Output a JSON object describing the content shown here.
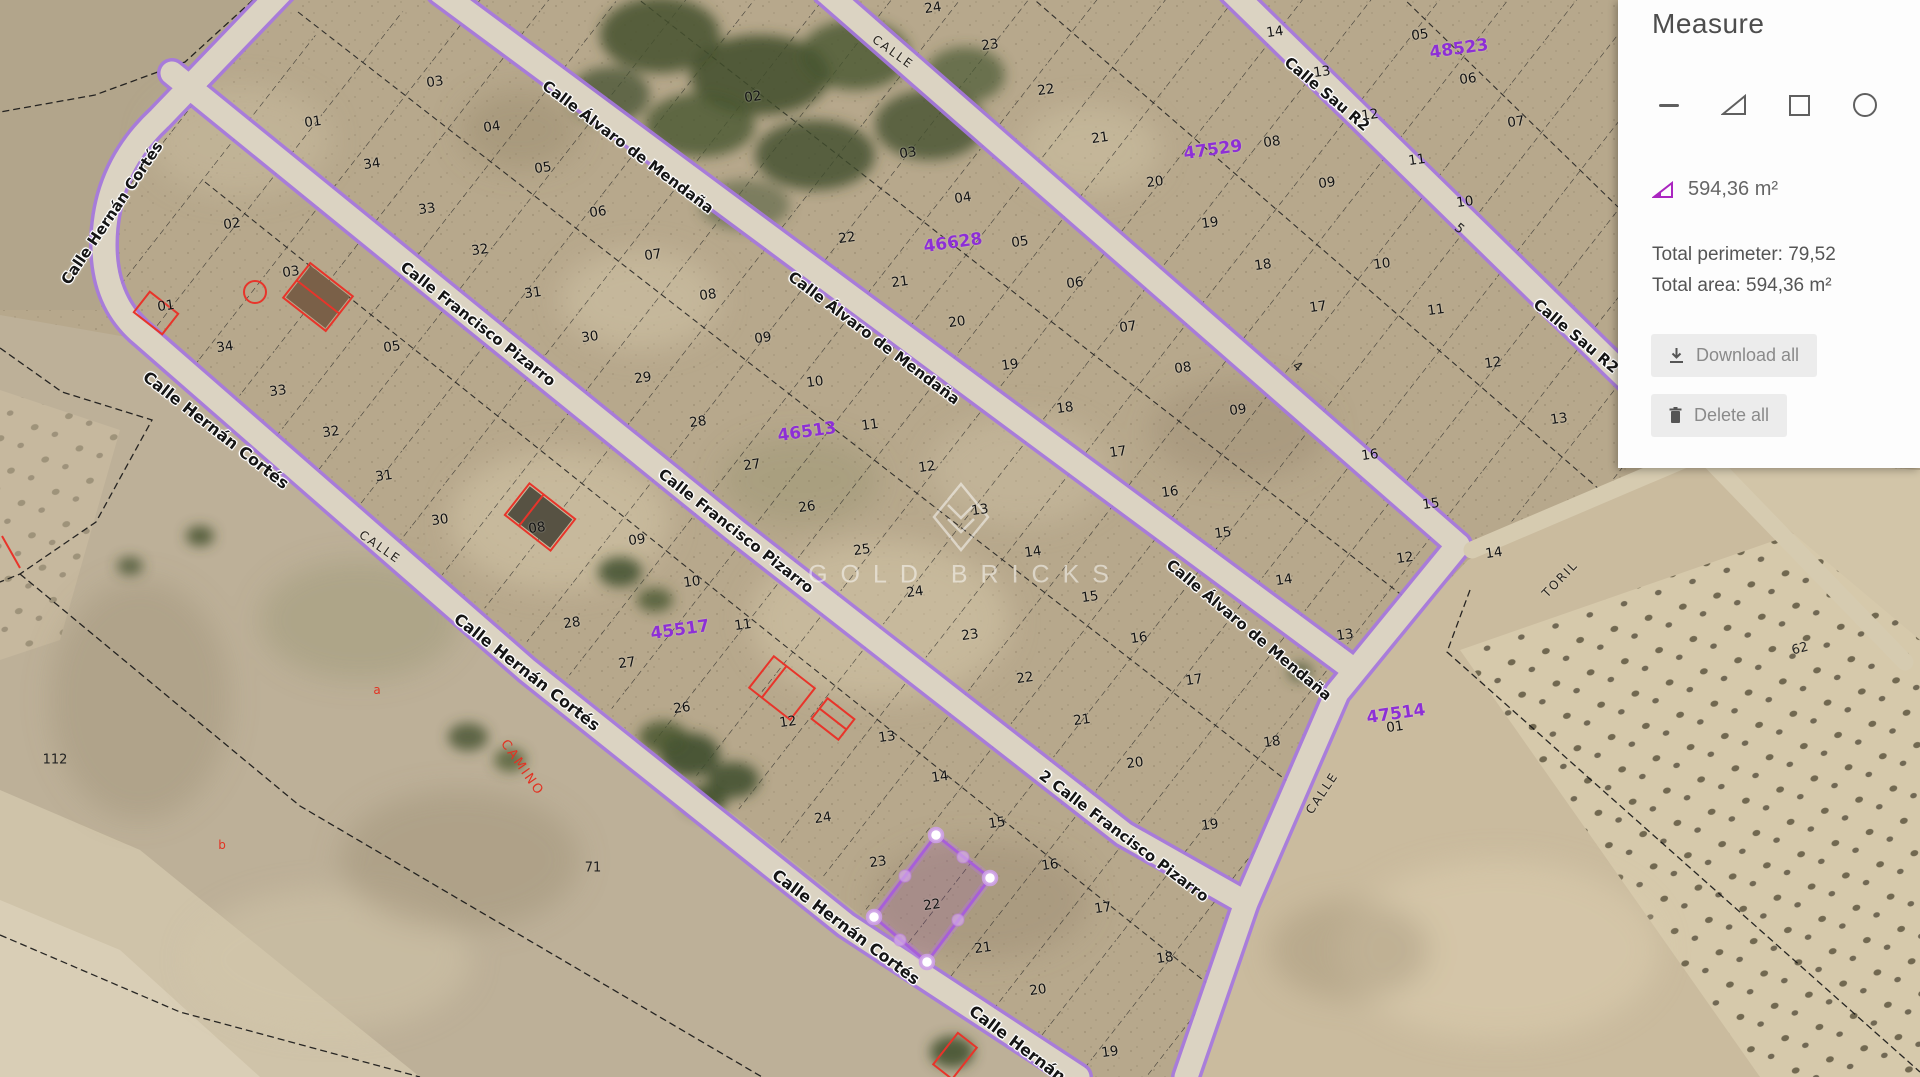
{
  "panel": {
    "title": "Measure",
    "tools": [
      {
        "name": "line-tool",
        "icon": "minus-line-icon"
      },
      {
        "name": "area-tool",
        "icon": "triangle-icon"
      },
      {
        "name": "rectangle-tool",
        "icon": "square-icon"
      },
      {
        "name": "circle-tool",
        "icon": "circle-icon"
      }
    ],
    "measurement_value": "594,36 m²",
    "total_perimeter": "Total perimeter: 79,52",
    "total_area": "Total area: 594,36 m²",
    "download_label": "Download all",
    "delete_label": "Delete all",
    "accent_color": "#a224b5"
  },
  "map": {
    "watermark_text": "GOLD BRICKS",
    "street_labels": [
      {
        "t": "Calle Hernán Cortés",
        "x": 112,
        "y": 213,
        "rot": -56,
        "size": 15
      },
      {
        "t": "Calle Hernán Cortés",
        "x": 216,
        "y": 430,
        "rot": 38,
        "size": 16
      },
      {
        "t": "Calle Hernán Cortés",
        "x": 527,
        "y": 672,
        "rot": 38,
        "size": 16
      },
      {
        "t": "Calle Hernán Cortés",
        "x": 846,
        "y": 927,
        "rot": 37,
        "size": 16
      },
      {
        "t": "Calle Hernán Cortés",
        "x": 1043,
        "y": 1063,
        "rot": 37,
        "size": 16
      },
      {
        "t": "Calle Francisco Pizarro",
        "x": 478,
        "y": 324,
        "rot": 38,
        "size": 15
      },
      {
        "t": "Calle Francisco Pizarro",
        "x": 736,
        "y": 531,
        "rot": 38,
        "size": 15
      },
      {
        "t": "2 Calle Francisco Pizarro",
        "x": 1124,
        "y": 836,
        "rot": 37,
        "size": 15
      },
      {
        "t": "Calle Álvaro de Mendaña",
        "x": 628,
        "y": 147,
        "rot": 37,
        "size": 15
      },
      {
        "t": "Calle Álvaro de Mendaña",
        "x": 874,
        "y": 338,
        "rot": 37,
        "size": 15
      },
      {
        "t": "Calle Álvaro de Mendaña",
        "x": 1249,
        "y": 630,
        "rot": 40,
        "size": 15
      },
      {
        "t": "Calle Sau R2",
        "x": 1327,
        "y": 94,
        "rot": 40,
        "size": 15
      },
      {
        "t": "Calle Sau R2",
        "x": 1576,
        "y": 336,
        "rot": 40,
        "size": 15
      }
    ],
    "minor_road_labels": [
      {
        "t": "CALLE",
        "x": 893,
        "y": 52,
        "rot": 36
      },
      {
        "t": "CALLE",
        "x": 380,
        "y": 547,
        "rot": 35
      },
      {
        "t": "CALLE",
        "x": 1322,
        "y": 793,
        "rot": -56
      },
      {
        "t": "TORIL",
        "x": 1560,
        "y": 579,
        "rot": -46
      }
    ],
    "parcel_numbers": [
      {
        "t": "01",
        "x": 313,
        "y": 122
      },
      {
        "t": "34",
        "x": 372,
        "y": 164
      },
      {
        "t": "02",
        "x": 232,
        "y": 224
      },
      {
        "t": "03",
        "x": 291,
        "y": 272
      },
      {
        "t": "01",
        "x": 166,
        "y": 306
      },
      {
        "t": "34",
        "x": 225,
        "y": 347
      },
      {
        "t": "33",
        "x": 278,
        "y": 391
      },
      {
        "t": "32",
        "x": 331,
        "y": 432
      },
      {
        "t": "31",
        "x": 384,
        "y": 476
      },
      {
        "t": "30",
        "x": 440,
        "y": 520
      },
      {
        "t": "05",
        "x": 392,
        "y": 347
      },
      {
        "t": "03",
        "x": 435,
        "y": 82
      },
      {
        "t": "04",
        "x": 492,
        "y": 127
      },
      {
        "t": "05",
        "x": 543,
        "y": 168
      },
      {
        "t": "06",
        "x": 598,
        "y": 212
      },
      {
        "t": "07",
        "x": 653,
        "y": 255
      },
      {
        "t": "08",
        "x": 708,
        "y": 295
      },
      {
        "t": "09",
        "x": 763,
        "y": 338
      },
      {
        "t": "10",
        "x": 815,
        "y": 382
      },
      {
        "t": "11",
        "x": 870,
        "y": 425
      },
      {
        "t": "12",
        "x": 927,
        "y": 467
      },
      {
        "t": "13",
        "x": 980,
        "y": 510
      },
      {
        "t": "14",
        "x": 1033,
        "y": 552
      },
      {
        "t": "15",
        "x": 1090,
        "y": 597
      },
      {
        "t": "16",
        "x": 1139,
        "y": 638
      },
      {
        "t": "17",
        "x": 1194,
        "y": 680
      },
      {
        "t": "18",
        "x": 1272,
        "y": 742
      },
      {
        "t": "33",
        "x": 427,
        "y": 209
      },
      {
        "t": "32",
        "x": 480,
        "y": 250
      },
      {
        "t": "31",
        "x": 533,
        "y": 293
      },
      {
        "t": "30",
        "x": 590,
        "y": 337
      },
      {
        "t": "29",
        "x": 643,
        "y": 378
      },
      {
        "t": "28",
        "x": 698,
        "y": 422
      },
      {
        "t": "27",
        "x": 752,
        "y": 465
      },
      {
        "t": "26",
        "x": 807,
        "y": 507
      },
      {
        "t": "25",
        "x": 862,
        "y": 550
      },
      {
        "t": "24",
        "x": 915,
        "y": 592
      },
      {
        "t": "23",
        "x": 970,
        "y": 635
      },
      {
        "t": "22",
        "x": 1025,
        "y": 678
      },
      {
        "t": "21",
        "x": 1082,
        "y": 720
      },
      {
        "t": "20",
        "x": 1135,
        "y": 763
      },
      {
        "t": "19",
        "x": 1210,
        "y": 825
      },
      {
        "t": "02",
        "x": 753,
        "y": 97
      },
      {
        "t": "03",
        "x": 908,
        "y": 153
      },
      {
        "t": "04",
        "x": 963,
        "y": 198
      },
      {
        "t": "05",
        "x": 1020,
        "y": 242
      },
      {
        "t": "06",
        "x": 1075,
        "y": 283
      },
      {
        "t": "07",
        "x": 1128,
        "y": 327
      },
      {
        "t": "08",
        "x": 1183,
        "y": 368
      },
      {
        "t": "09",
        "x": 1238,
        "y": 410
      },
      {
        "t": "22",
        "x": 847,
        "y": 238
      },
      {
        "t": "21",
        "x": 900,
        "y": 282
      },
      {
        "t": "20",
        "x": 957,
        "y": 322
      },
      {
        "t": "19",
        "x": 1010,
        "y": 365
      },
      {
        "t": "18",
        "x": 1065,
        "y": 408
      },
      {
        "t": "17",
        "x": 1118,
        "y": 452
      },
      {
        "t": "16",
        "x": 1170,
        "y": 492
      },
      {
        "t": "15",
        "x": 1223,
        "y": 533
      },
      {
        "t": "14",
        "x": 1284,
        "y": 580
      },
      {
        "t": "13",
        "x": 1345,
        "y": 635
      },
      {
        "t": "12",
        "x": 1405,
        "y": 558
      },
      {
        "t": "21",
        "x": 1100,
        "y": 138
      },
      {
        "t": "20",
        "x": 1155,
        "y": 182
      },
      {
        "t": "19",
        "x": 1210,
        "y": 223
      },
      {
        "t": "18",
        "x": 1263,
        "y": 265
      },
      {
        "t": "17",
        "x": 1318,
        "y": 307
      },
      {
        "t": "14",
        "x": 1275,
        "y": 32
      },
      {
        "t": "13",
        "x": 1322,
        "y": 72
      },
      {
        "t": "12",
        "x": 1370,
        "y": 115
      },
      {
        "t": "11",
        "x": 1417,
        "y": 160
      },
      {
        "t": "10",
        "x": 1465,
        "y": 202
      },
      {
        "t": "08",
        "x": 1272,
        "y": 142
      },
      {
        "t": "09",
        "x": 1327,
        "y": 183
      },
      {
        "t": "10",
        "x": 1382,
        "y": 264
      },
      {
        "t": "11",
        "x": 1436,
        "y": 310
      },
      {
        "t": "12",
        "x": 1493,
        "y": 363
      },
      {
        "t": "13",
        "x": 1559,
        "y": 419
      },
      {
        "t": "16",
        "x": 1370,
        "y": 455
      },
      {
        "t": "15",
        "x": 1431,
        "y": 504
      },
      {
        "t": "14",
        "x": 1494,
        "y": 553
      },
      {
        "t": "05",
        "x": 1420,
        "y": 35
      },
      {
        "t": "06",
        "x": 1468,
        "y": 79
      },
      {
        "t": "07",
        "x": 1516,
        "y": 122
      },
      {
        "t": "24",
        "x": 933,
        "y": 8
      },
      {
        "t": "23",
        "x": 990,
        "y": 45
      },
      {
        "t": "22",
        "x": 1046,
        "y": 90
      },
      {
        "t": "08",
        "x": 537,
        "y": 528
      },
      {
        "t": "09",
        "x": 637,
        "y": 540
      },
      {
        "t": "10",
        "x": 692,
        "y": 582
      },
      {
        "t": "11",
        "x": 743,
        "y": 625
      },
      {
        "t": "28",
        "x": 572,
        "y": 623
      },
      {
        "t": "27",
        "x": 627,
        "y": 663
      },
      {
        "t": "26",
        "x": 682,
        "y": 708
      },
      {
        "t": "12",
        "x": 788,
        "y": 722
      },
      {
        "t": "13",
        "x": 887,
        "y": 737
      },
      {
        "t": "14",
        "x": 940,
        "y": 777
      },
      {
        "t": "15",
        "x": 997,
        "y": 823
      },
      {
        "t": "16",
        "x": 1050,
        "y": 865
      },
      {
        "t": "17",
        "x": 1103,
        "y": 908
      },
      {
        "t": "18",
        "x": 1165,
        "y": 958
      },
      {
        "t": "24",
        "x": 823,
        "y": 818
      },
      {
        "t": "23",
        "x": 878,
        "y": 862
      },
      {
        "t": "22",
        "x": 932,
        "y": 905
      },
      {
        "t": "21",
        "x": 983,
        "y": 948
      },
      {
        "t": "20",
        "x": 1038,
        "y": 990
      },
      {
        "t": "19",
        "x": 1110,
        "y": 1052
      },
      {
        "t": "01",
        "x": 1395,
        "y": 727
      }
    ],
    "block_ids": [
      {
        "t": "48523",
        "x": 1459,
        "y": 49
      },
      {
        "t": "47529",
        "x": 1213,
        "y": 150
      },
      {
        "t": "46628",
        "x": 953,
        "y": 243
      },
      {
        "t": "46513",
        "x": 807,
        "y": 432
      },
      {
        "t": "45517",
        "x": 680,
        "y": 630
      },
      {
        "t": "47514",
        "x": 1396,
        "y": 714
      }
    ],
    "red_labels": [
      {
        "t": "CAMINO",
        "x": 522,
        "y": 768,
        "rot": 55,
        "cls": "redcap"
      },
      {
        "t": "a",
        "x": 377,
        "y": 690,
        "rot": 0,
        "cls": "redl"
      },
      {
        "t": "b",
        "x": 222,
        "y": 845,
        "rot": 0,
        "cls": "redl"
      }
    ],
    "terrain_labels": [
      {
        "t": "112",
        "x": 55,
        "y": 760,
        "rot": 0
      },
      {
        "t": "71",
        "x": 593,
        "y": 868,
        "rot": 0
      },
      {
        "t": "62",
        "x": 1800,
        "y": 649,
        "rot": -15
      },
      {
        "t": "5",
        "x": 1459,
        "y": 229,
        "rot": 40
      },
      {
        "t": "4",
        "x": 1297,
        "y": 367,
        "rot": 40
      }
    ],
    "measure_polygon": {
      "vertices": [
        [
          936,
          835
        ],
        [
          990,
          878
        ],
        [
          927,
          962
        ],
        [
          874,
          917
        ]
      ],
      "midpoints": [
        [
          963,
          857
        ],
        [
          958,
          920
        ],
        [
          900,
          940
        ],
        [
          905,
          876
        ]
      ],
      "stroke": "#a75fd8",
      "fill": "rgba(150,60,190,0.14)"
    }
  }
}
